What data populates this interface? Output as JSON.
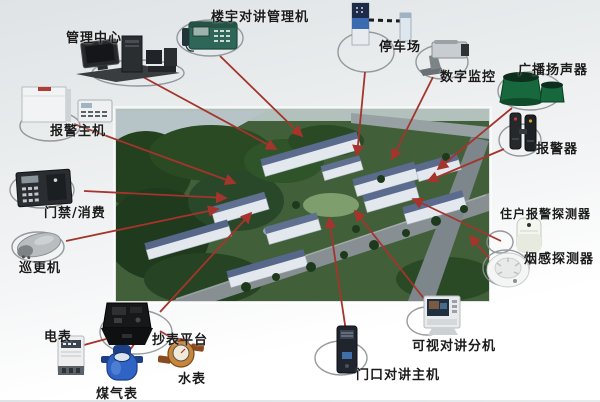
{
  "diagram": {
    "type": "system-topology",
    "accent_line_color": "#a4342c",
    "ellipse_color": "#8b9094",
    "center": {
      "description_visible": false
    },
    "devices": [
      {
        "id": "management-center",
        "label": "管理中心"
      },
      {
        "id": "building-intercom-manager",
        "label": "楼宇对讲管理机"
      },
      {
        "id": "parking-lot",
        "label": "停车场"
      },
      {
        "id": "digital-surveillance",
        "label": "数字监控"
      },
      {
        "id": "broadcast-speaker",
        "label": "广播扬声器"
      },
      {
        "id": "alarm-host",
        "label": "报警主机"
      },
      {
        "id": "alarm-siren",
        "label": "报警器"
      },
      {
        "id": "access-control-pos",
        "label": "门禁/消费"
      },
      {
        "id": "resident-alarm-detector",
        "label": "住户报警探测器"
      },
      {
        "id": "patrol-reader",
        "label": "巡更机"
      },
      {
        "id": "smoke-detector",
        "label": "烟感探测器"
      },
      {
        "id": "electric-meter",
        "label": "电表"
      },
      {
        "id": "meter-reading-platform",
        "label": "抄表平台"
      },
      {
        "id": "gas-meter",
        "label": "煤气表"
      },
      {
        "id": "water-meter",
        "label": "水表"
      },
      {
        "id": "entrance-intercom-host",
        "label": "门口对讲主机"
      },
      {
        "id": "video-intercom-extension",
        "label": "可视对讲分机"
      }
    ]
  }
}
